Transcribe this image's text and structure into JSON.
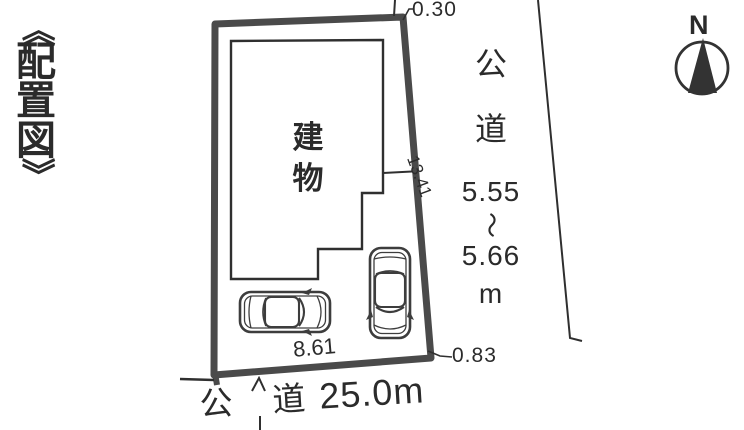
{
  "title": "《配置図》",
  "title_chars": [
    "《",
    "配",
    "置",
    "図",
    "》"
  ],
  "compass": {
    "north_label": "N"
  },
  "site_plan": {
    "building_label_chars": [
      "建",
      "物"
    ],
    "dimensions": {
      "top_corner_offset": "0.30",
      "right_boundary_length": "13.41",
      "parking_frontage": "8.61",
      "bottom_corner_offset": "0.83"
    }
  },
  "roads": {
    "right_road": {
      "name_chars": [
        "公",
        "道"
      ],
      "width_min": "5.55",
      "range_tilde": "〜",
      "width_max": "5.66",
      "unit": "m"
    },
    "bottom_road": {
      "name_chars": [
        "公",
        "道"
      ],
      "width": "25.0m"
    }
  },
  "icons": {
    "compass": "north-arrow-compass",
    "vehicles": [
      "car-top-view-horizontal",
      "car-top-view-vertical"
    ]
  },
  "colors": {
    "ink": "#2b2b2b",
    "thin_line": "#2f2f2f",
    "boundary": "#4a4a4a",
    "background": "#ffffff"
  }
}
